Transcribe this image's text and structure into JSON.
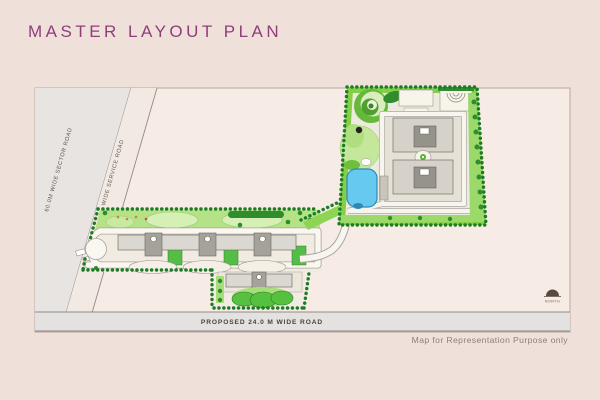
{
  "page": {
    "title": "MASTER LAYOUT PLAN",
    "disclaimer": "Map for Representation Purpose only"
  },
  "plan": {
    "roads": {
      "sector_road": "60.0M WIDE SECTOR ROAD",
      "service_road": "12 M WIDE SERVICE ROAD",
      "proposed_road": "PROPOSED 24.0 M WIDE ROAD"
    },
    "compass": {
      "label": "NORTH"
    },
    "colors": {
      "background": "#efe0d9",
      "paper": "#f7ebe5",
      "title_accent": "#8f3e7c",
      "road_gray": "#e7e4e2",
      "lawn_green": "#aede7f",
      "bright_green": "#84d044",
      "hedge_dark_green": "#1d7a25",
      "pool_blue": "#66c9ef",
      "building_gray": "#d6d2c9",
      "tower_gray": "#9a968e"
    },
    "features": [
      "upper-towers-cluster",
      "row-housing-cluster",
      "swimming-pool",
      "spiral-garden",
      "amphitheater",
      "landscape-mounds"
    ]
  }
}
